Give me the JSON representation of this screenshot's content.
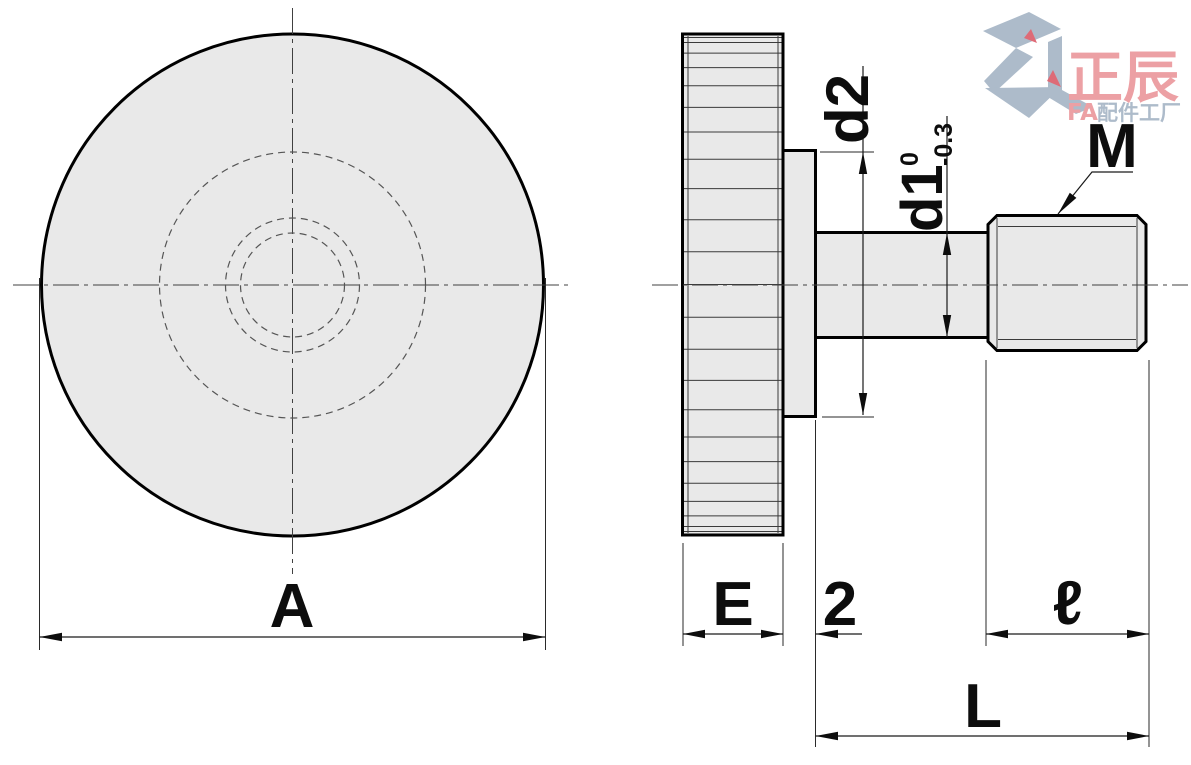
{
  "front_view": {
    "dim_a": "A"
  },
  "side_view": {
    "dim_d2": "d2",
    "dim_d1": "d1",
    "d1_tol_upper": "0",
    "d1_tol_lower": "-0.3",
    "thread_label": "M",
    "dim_e": "E",
    "dim_neck": "2",
    "dim_thread_len": "ℓ",
    "dim_total_len": "L"
  },
  "logo": {
    "brand_cn": "正辰",
    "brand_fa": "FA",
    "brand_suffix": "配件工厂"
  },
  "colors": {
    "part_fill": "#e9e9e9",
    "outline": "#000000",
    "dim_line": "#1a1a1a",
    "logo_blue": "#a9b8c8",
    "logo_pink": "#ec9ba0",
    "logo_red": "#dd6470"
  }
}
